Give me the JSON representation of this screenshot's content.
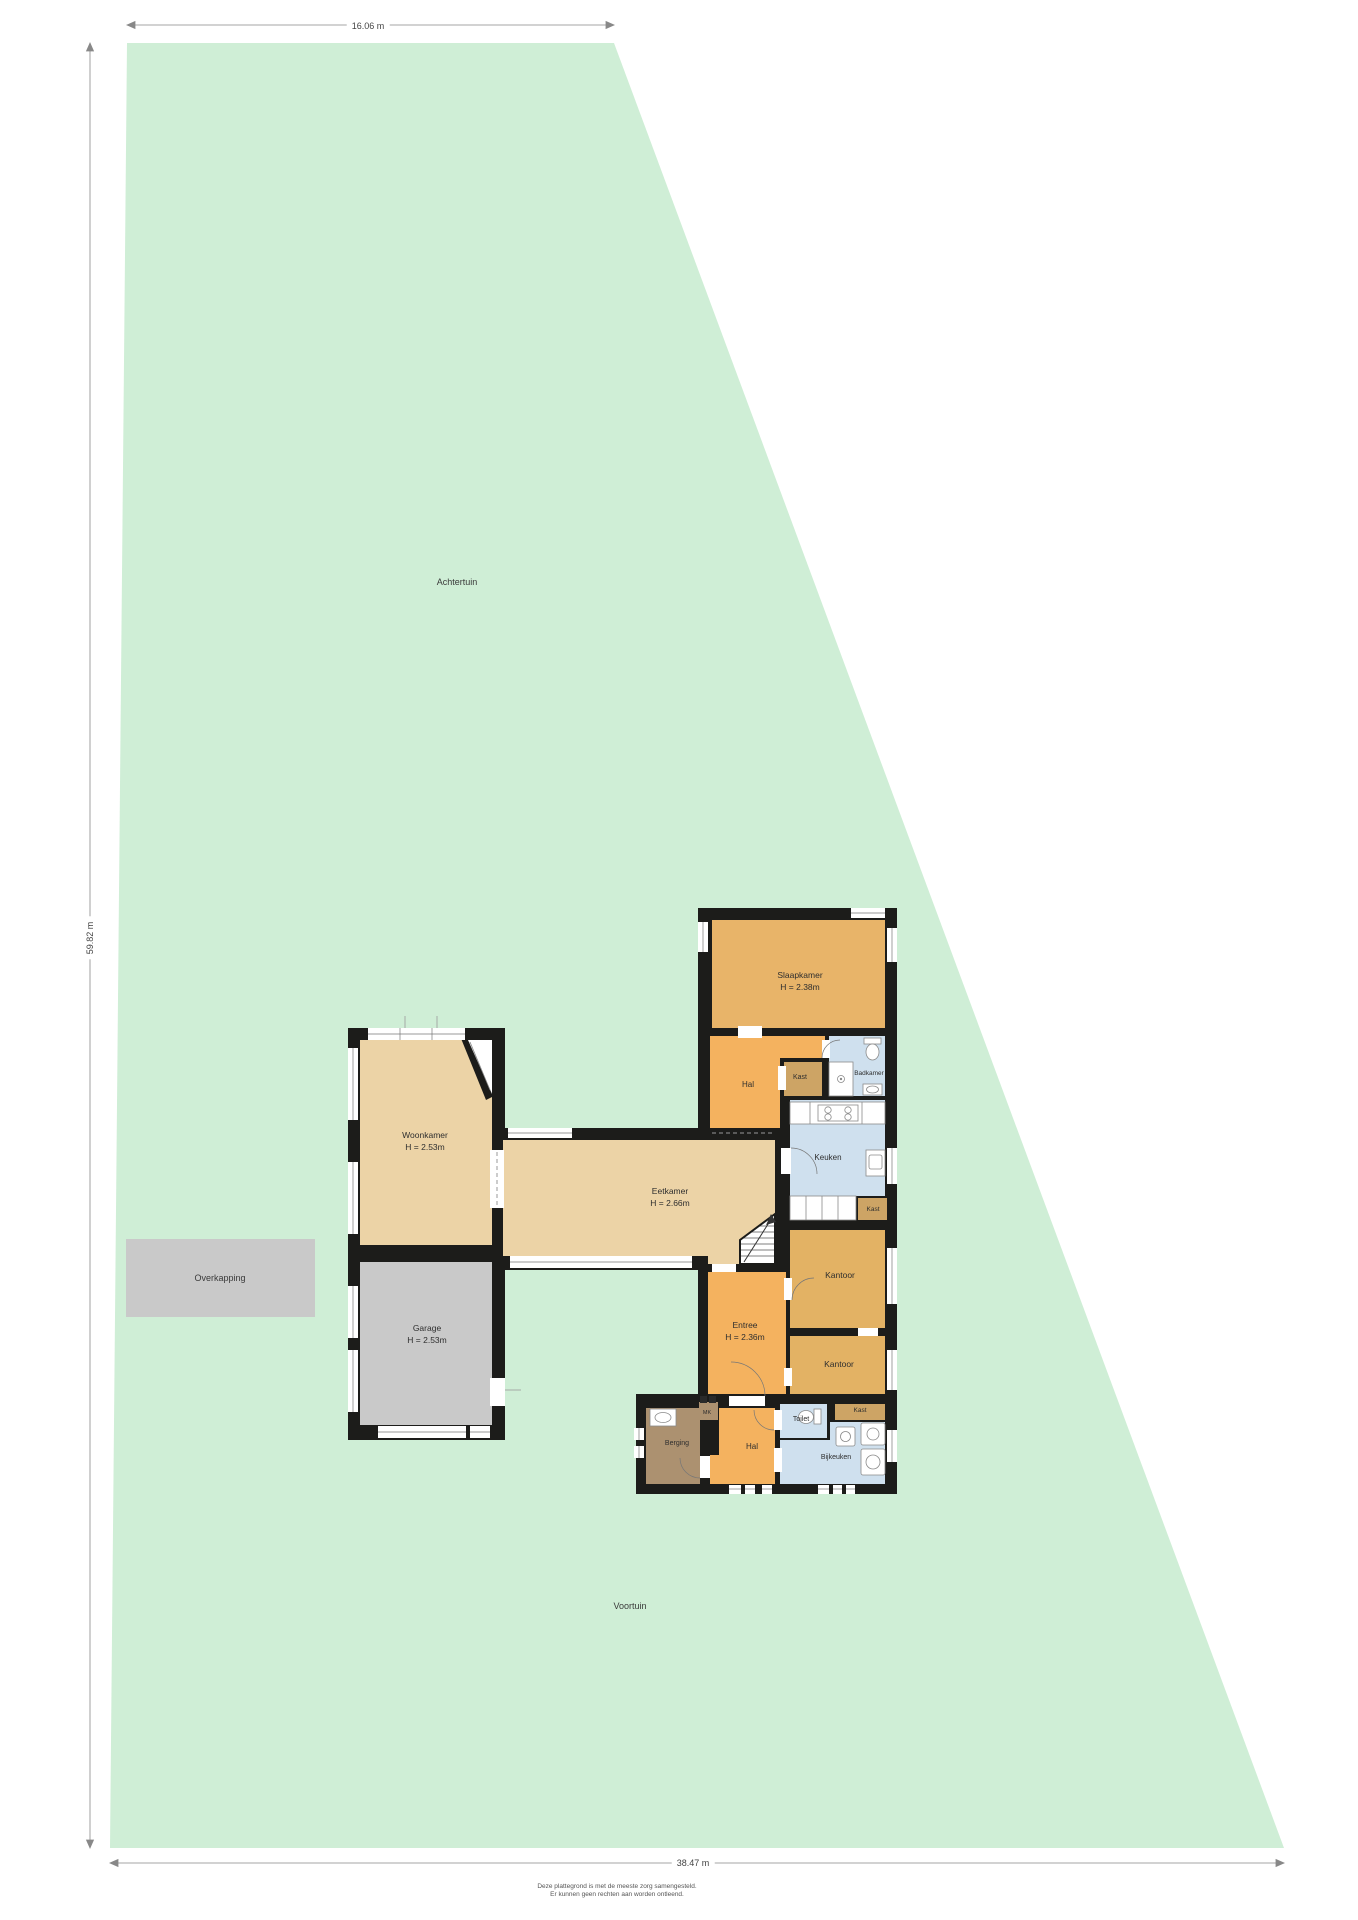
{
  "plan": {
    "scale": {
      "top": "16.06 m",
      "left": "59.82 m",
      "bottom": "38.47 m"
    },
    "gardens": {
      "back": "Achtertuin",
      "front": "Voortuin",
      "carport": "Overkapping"
    },
    "rooms": {
      "slaapkamer": {
        "name": "Slaapkamer",
        "height": "H = 2.38m"
      },
      "hal_boven": {
        "name": "Hal"
      },
      "kast_hal": {
        "name": "Kast"
      },
      "badkamer": {
        "name": "Badkamer"
      },
      "keuken": {
        "name": "Keuken"
      },
      "kast_keuken": {
        "name": "Kast"
      },
      "kantoor_1": {
        "name": "Kantoor"
      },
      "kantoor_2": {
        "name": "Kantoor"
      },
      "entree": {
        "name": "Entree",
        "height": "H = 2.36m"
      },
      "eetkamer": {
        "name": "Eetkamer",
        "height": "H = 2.66m"
      },
      "woonkamer": {
        "name": "Woonkamer",
        "height": "H = 2.53m"
      },
      "garage": {
        "name": "Garage",
        "height": "H = 2.53m"
      },
      "berging": {
        "name": "Berging"
      },
      "meterkast": {
        "name": "MK"
      },
      "hal_beneden": {
        "name": "Hal"
      },
      "toilet": {
        "name": "Toilet"
      },
      "kast_bijkeuken": {
        "name": "Kast"
      },
      "bijkeuken": {
        "name": "Bijkeuken"
      }
    },
    "disclaimer": {
      "line1": "Deze plattegrond is met de meeste zorg samengesteld.",
      "line2": "Er kunnen geen rechten aan worden ontleend."
    },
    "colors": {
      "garden": "#cfeed6",
      "wall": "#1c1c1a",
      "room_orange": "#f4b25f",
      "room_amber": "#e8b469",
      "room_ocher": "#e3b264",
      "room_tan": "#ecd3a6",
      "room_kast": "#cda465",
      "room_blue": "#cfe0ee",
      "room_brown": "#ac9170",
      "gray": "#c9c9c9"
    }
  }
}
